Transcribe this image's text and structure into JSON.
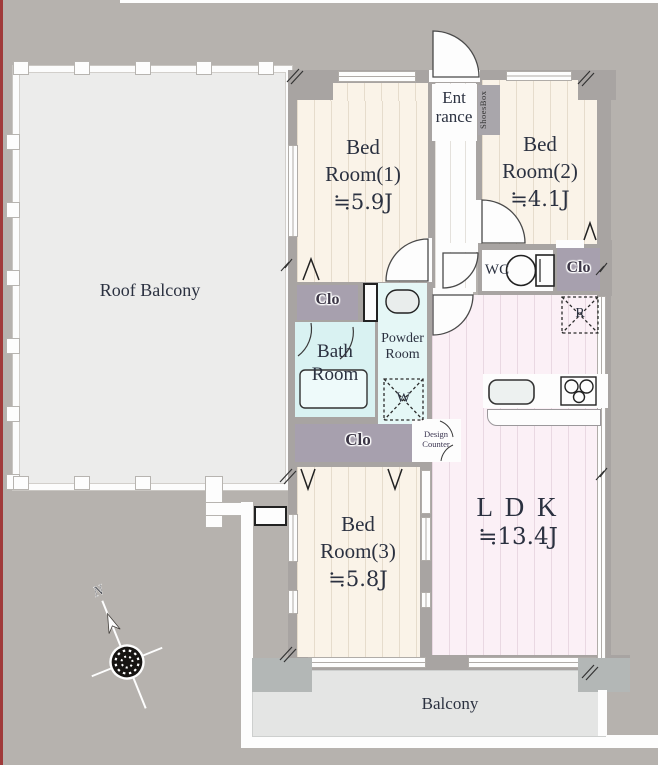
{
  "plan": {
    "roof_balcony": {
      "label": "Roof Balcony"
    },
    "bedroom1": {
      "line1": "Bed",
      "line2": "Room(1)",
      "area": "≒5.9J"
    },
    "bedroom2": {
      "line1": "Bed",
      "line2": "Room(2)",
      "area": "≒4.1J"
    },
    "bedroom3": {
      "line1": "Bed",
      "line2": "Room(3)",
      "area": "≒5.8J"
    },
    "ldk": {
      "label": "L D K",
      "area": "≒13.4J"
    },
    "entrance": {
      "line1": "Ent",
      "line2": "rance"
    },
    "shoes_box": {
      "label": "ShoesBox"
    },
    "wc": {
      "label": "WC"
    },
    "closet_hall": {
      "label": "Clo"
    },
    "closet_mid": {
      "label": "Clo"
    },
    "closet_south": {
      "label": "Clo"
    },
    "bath": {
      "line1": "Bath",
      "line2": "Room"
    },
    "powder": {
      "line1": "Powder",
      "line2": "Room"
    },
    "washing_machine": {
      "label": "W"
    },
    "refrigerator": {
      "label": "R"
    },
    "design_counter": {
      "line1": "Design",
      "line2": "Counter"
    },
    "balcony": {
      "label": "Balcony"
    },
    "compass": {
      "north": "N"
    }
  },
  "colors": {
    "background": "#b6b2ae",
    "wall": "#a8a4a2",
    "room_cream": "#faf3e8",
    "room_pink": "#fbf0f6",
    "bath_cyan": "#d9f2f2",
    "powder_cyan": "#e5f7f6",
    "closet_purple": "#a7a0ae",
    "balcony_gray": "#e4e5e4",
    "roof_balcony_gray": "#ececeb",
    "edge_red": "#a03a3a",
    "text": "#2b3140"
  }
}
